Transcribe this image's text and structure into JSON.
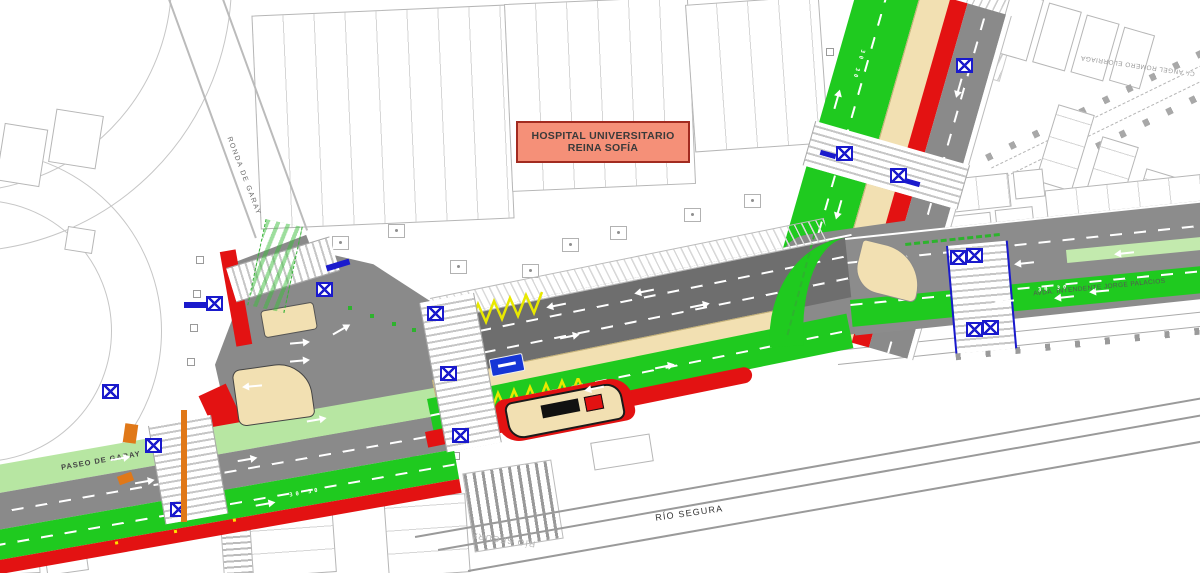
{
  "plan": {
    "hospital_box": {
      "line1": "HOSPITAL UNIVERSITARIO",
      "line2": "REINA SOFÍA"
    },
    "streets": {
      "ronda_de_garay": "RONDA DE GARAY",
      "paseo_de_garay": "PASEO DE GARAY",
      "avda_intendente": "AVDA. INTENDENTE JORGE PALACIOS",
      "angel_romero": "C/. ANGEL ROMERO ELORRIAGA"
    },
    "river": {
      "label": "RÍO SEGURA",
      "label_mirrored": "RÍO SEGURA"
    },
    "markings": {
      "lane_speed": "30"
    },
    "colors": {
      "roadway": "#8a8a8a",
      "roadway_dark": "#6e6e6e",
      "bike_bus_green": "#1fca1f",
      "landscape_green": "#b7e6a2",
      "bus_lane_red": "#e31212",
      "median_beige": "#f2e0b2",
      "signal_blue": "#1a1acc",
      "zigzag_yellow": "#e8e800",
      "works_orange": "#e07818",
      "hospital_fill": "#f59078",
      "hospital_border": "#a22b20"
    }
  }
}
